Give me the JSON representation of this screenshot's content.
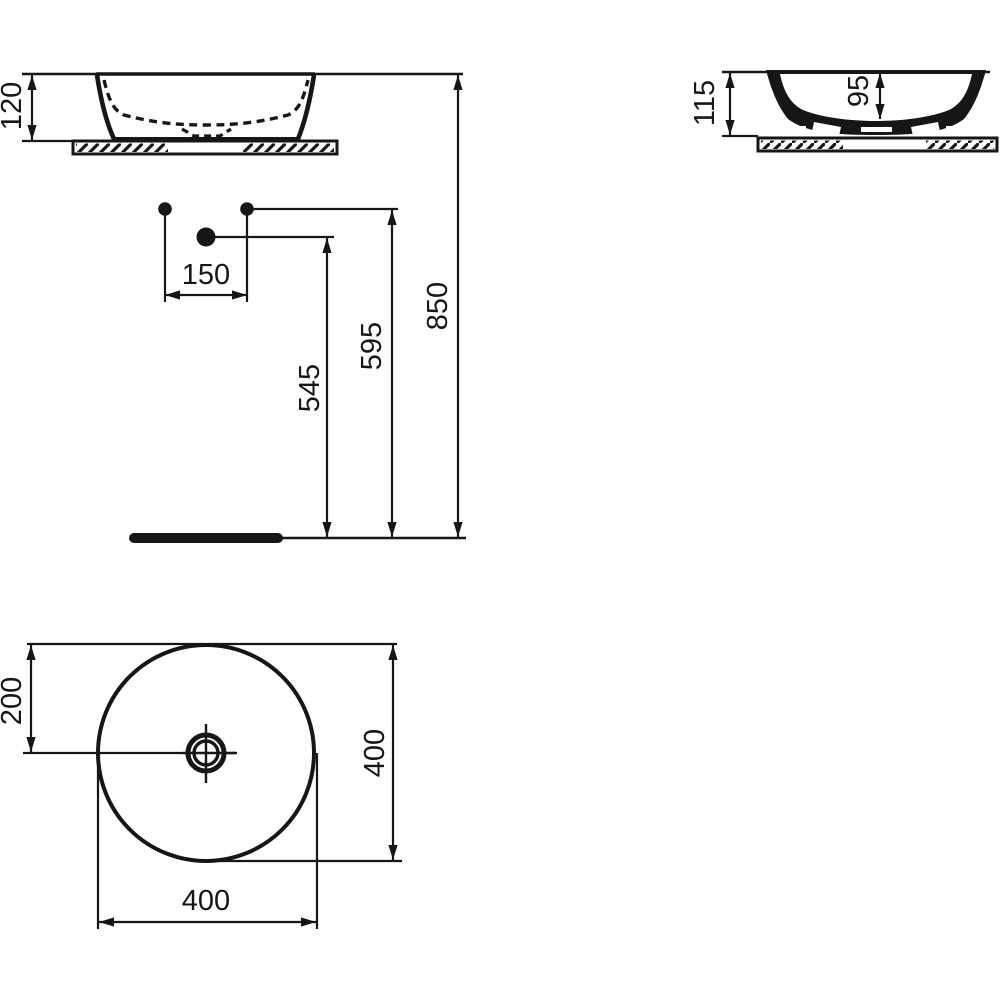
{
  "colors": {
    "line": "#161616",
    "background": "#ffffff"
  },
  "views": {
    "front": {
      "height": "120"
    },
    "section": {
      "overall_height": "115",
      "bowl_depth": "95"
    },
    "installation": {
      "tap_spacing": "150",
      "drain_height": "545",
      "connection_height": "595",
      "rim_height": "850"
    },
    "top": {
      "center_offset": "200",
      "diameter_vertical": "400",
      "diameter_horizontal": "400"
    }
  }
}
